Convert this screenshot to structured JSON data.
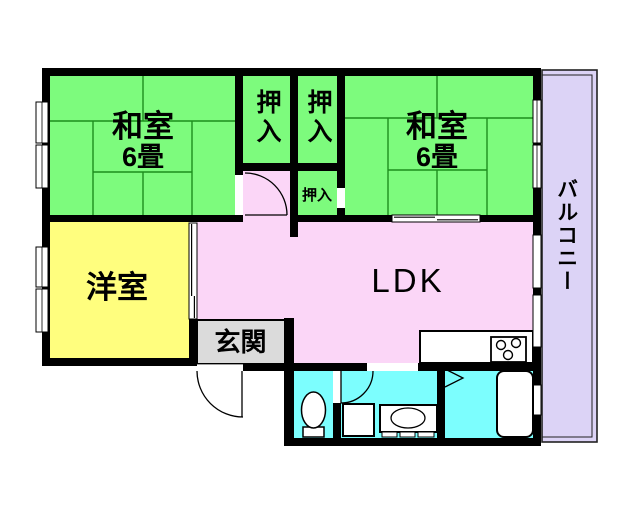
{
  "plan": {
    "rooms": {
      "washitsu_left": {
        "label": "和室",
        "size": "6畳"
      },
      "washitsu_right": {
        "label": "和室",
        "size": "6畳"
      },
      "oshiire_left": {
        "label": "押入"
      },
      "oshiire_right": {
        "label": "押入"
      },
      "oshiire_small": {
        "label": "押入"
      },
      "youshitsu": {
        "label": "洋室"
      },
      "ldk": {
        "label": "LDK"
      },
      "genkan": {
        "label": "玄関"
      },
      "balcony": {
        "label": "バルコニー"
      }
    },
    "colors": {
      "tatami_green": "#7dfb7d",
      "tatami_line": "#0c7a0c",
      "room_pink": "#fbd6f7",
      "room_yellow": "#fffe7e",
      "wet_cyan": "#7cfefe",
      "balcony_lavender": "#dcd3f6",
      "genkan_gray": "#dbdbdb",
      "wall_black": "#000000",
      "outline": "#222222"
    }
  }
}
